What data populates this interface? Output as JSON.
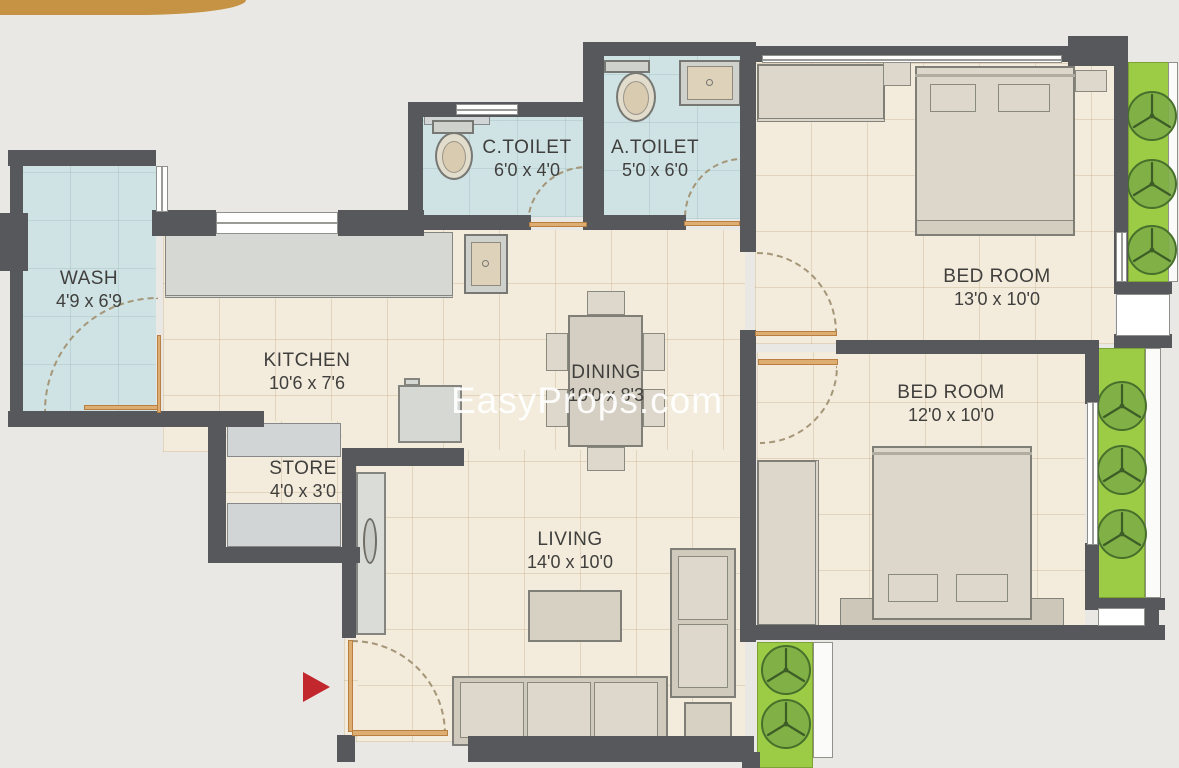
{
  "plan": {
    "watermark": "EasyProps.com",
    "rooms": {
      "wash": {
        "name": "WASH",
        "dims": "4'9 x 6'9"
      },
      "kitchen": {
        "name": "KITCHEN",
        "dims": "10'6 x 7'6"
      },
      "store": {
        "name": "STORE",
        "dims": "4'0 x 3'0"
      },
      "ctoilet": {
        "name": "C.TOILET",
        "dims": "6'0 x 4'0"
      },
      "atoilet": {
        "name": "A.TOILET",
        "dims": "5'0 x 6'0"
      },
      "dining": {
        "name": "DINING",
        "dims": "10'0 x 8'3"
      },
      "living": {
        "name": "LIVING",
        "dims": "14'0 x 10'0"
      },
      "bedroom1": {
        "name": "BED ROOM",
        "dims": "13'0 x 10'0"
      },
      "bedroom2": {
        "name": "BED ROOM",
        "dims": "12'0 x 10'0"
      }
    },
    "colors": {
      "wall": "#57585b",
      "floor_beige": "#f3ecdc",
      "wet_floor_blue": "#cfe3e5",
      "balcony_green": "#9ccb45",
      "tree_green": "#7fae47",
      "door_orange": "#ddad72",
      "entrance_arrow_red": "#c1272d",
      "banner_gold": "#c69345",
      "watermark_white": "#ffffff"
    }
  }
}
